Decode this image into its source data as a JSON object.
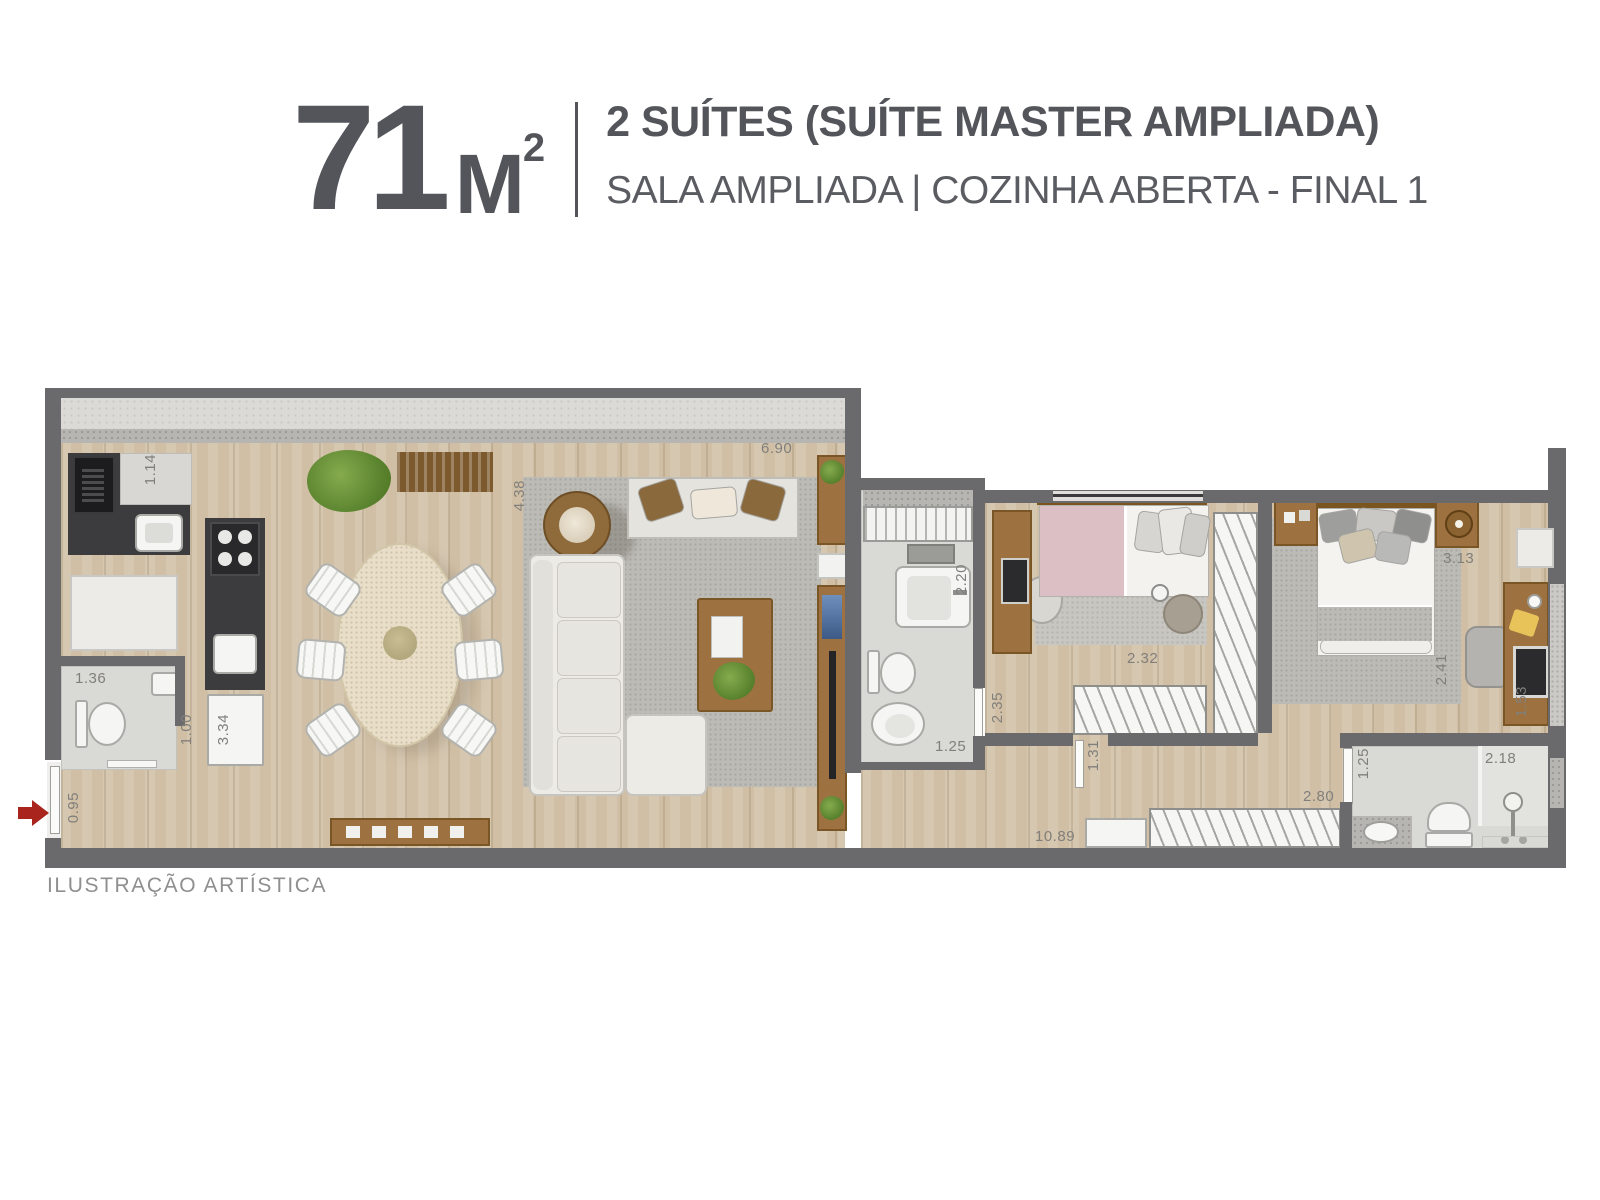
{
  "header": {
    "area_value": "71",
    "area_unit": "M",
    "area_sup": "2",
    "title_line1": "2 SUÍTES (SUÍTE MASTER AMPLIADA)",
    "title_line2": "SALA AMPLIADA | COZINHA ABERTA - FINAL 1"
  },
  "footer": {
    "disclaimer": "ILUSTRAÇÃO ARTÍSTICA"
  },
  "colors": {
    "title_text": "#54555a",
    "subtitle_text": "#5b5c61",
    "disclaimer_text": "#8f8f8f",
    "wall": "#6a696b",
    "wood_floor": "#d0bfa5",
    "rug": "#bcbbb6",
    "tile": "#d9d9d6",
    "furniture_wood": "#9e7140",
    "counter_dark": "#3c3c3e",
    "entry_arrow": "#a8241c",
    "dimension_text": "#817f7b"
  },
  "plan": {
    "dims": {
      "kitchen_counter": "1.14",
      "living_depth": "4.38",
      "living_width": "6.90",
      "lavabo_width": "1.36",
      "lavabo_depth": "1.00",
      "kitchen_island": "3.34",
      "entry_width": "0.95",
      "laundry_width": "2.20",
      "bath1_depth": "2.35",
      "bath1_width": "1.25",
      "closet1_width": "2.32",
      "hall_door": "1.31",
      "corridor_length": "10.89",
      "master_hall": "2.80",
      "master_width": "3.13",
      "master_depth": "2.41",
      "master_desk": "1.53",
      "bath2_width": "1.25",
      "bath2_shower": "2.18"
    }
  }
}
